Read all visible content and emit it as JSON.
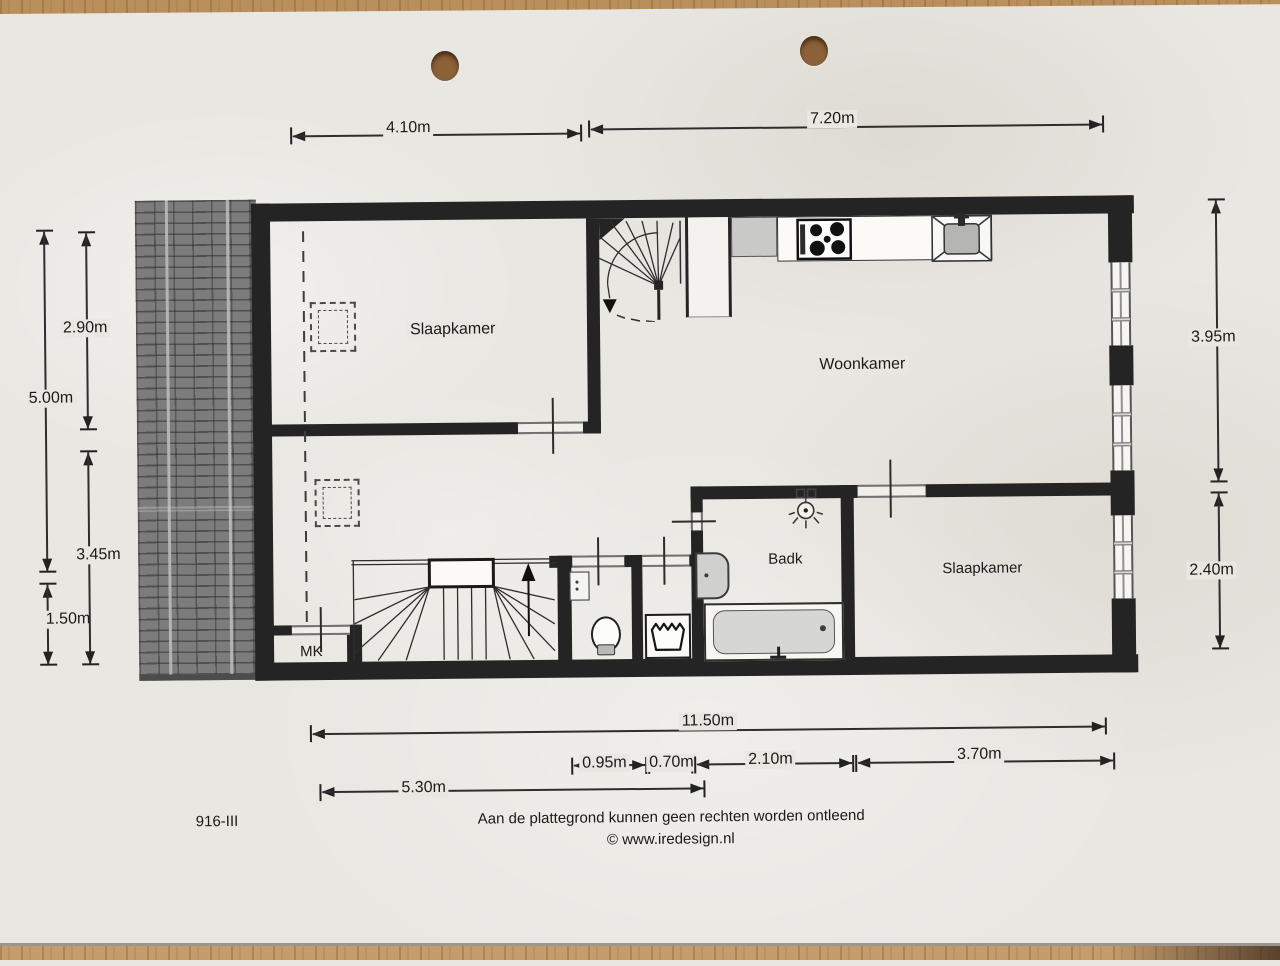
{
  "sheet": {
    "drawing_number": "916-III",
    "disclaimer": "Aan de plattegrond kunnen geen rechten worden ontleend",
    "copyright": "© www.iredesign.nl"
  },
  "rooms": {
    "bedroom_top": "Slaapkamer",
    "living_room": "Woonkamer",
    "bathroom": "Badk",
    "bedroom_bottom": "Slaapkamer",
    "meter_closet": "MK"
  },
  "dimensions": {
    "top_left_width": "4.10m",
    "top_right_width": "7.20m",
    "left_inner_upper": "2.90m",
    "left_outer_upper": "5.00m",
    "left_inner_lower": "3.45m",
    "left_outer_lower": "1.50m",
    "right_upper": "3.95m",
    "right_lower": "2.40m",
    "bottom_total": "11.50m",
    "bottom_toilet": "0.95m",
    "bottom_laundry": "0.70m",
    "bottom_bathroom": "2.10m",
    "bottom_bedroom": "3.70m",
    "bottom_hall": "5.30m"
  }
}
